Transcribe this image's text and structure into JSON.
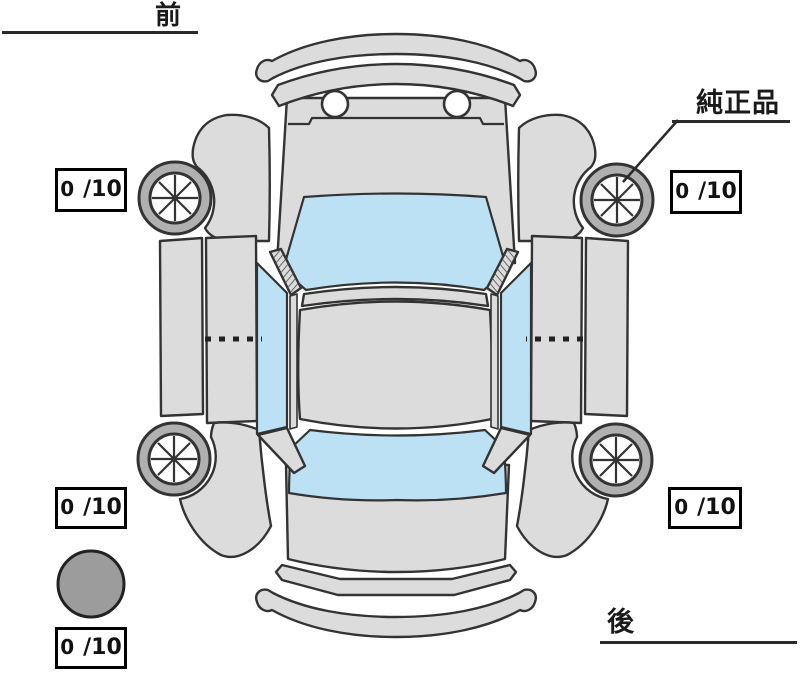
{
  "labels": {
    "front": "前",
    "rear": "後",
    "genuine_parts": "純正品"
  },
  "tires": {
    "front_left": "0",
    "front_right": "0",
    "rear_left": "0",
    "rear_right": "0",
    "spare": "0"
  },
  "score_suffix": "/10",
  "colors": {
    "body": "#dcdcdc",
    "glass": "#bce1f4",
    "outline": "#333333",
    "tire_ring": "#b0b0b0",
    "rim": "#ffffff",
    "spare_fill": "#9c9c9c",
    "text": "#1a1a1a"
  }
}
